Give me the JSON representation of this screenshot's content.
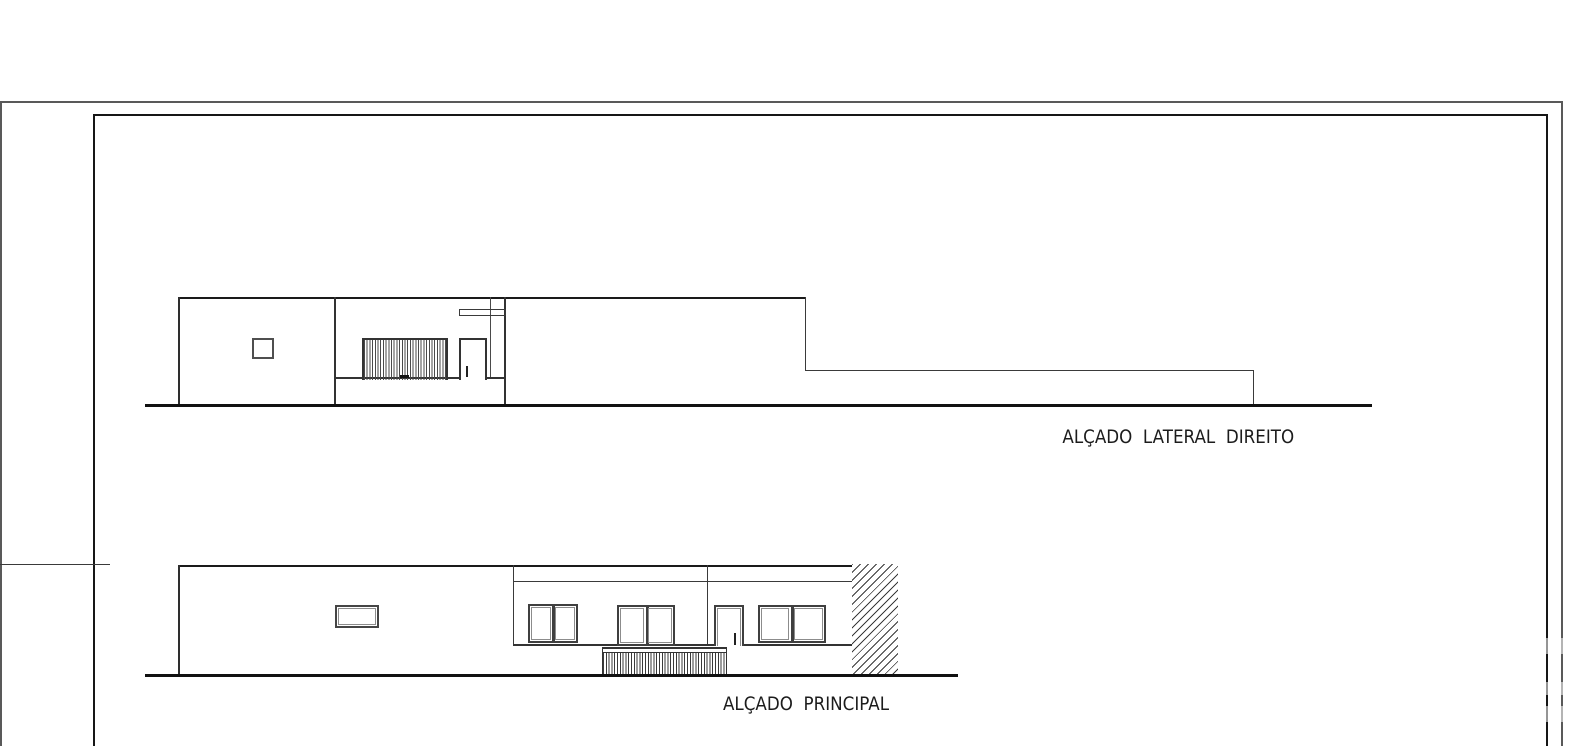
{
  "sheet": {
    "type": "architectural-elevation-drawing",
    "colors": {
      "background": "#ffffff",
      "line_heavy": "#111111",
      "line_medium": "#333333",
      "line_thin": "#3a3a3a",
      "frame_outer": "#595959",
      "frame_inner": "#161616",
      "text": "#1c1c1c"
    }
  },
  "labels": {
    "lateral": "ALÇADO  LATERAL  DIREITO",
    "principal": "ALÇADO  PRINCIPAL"
  }
}
